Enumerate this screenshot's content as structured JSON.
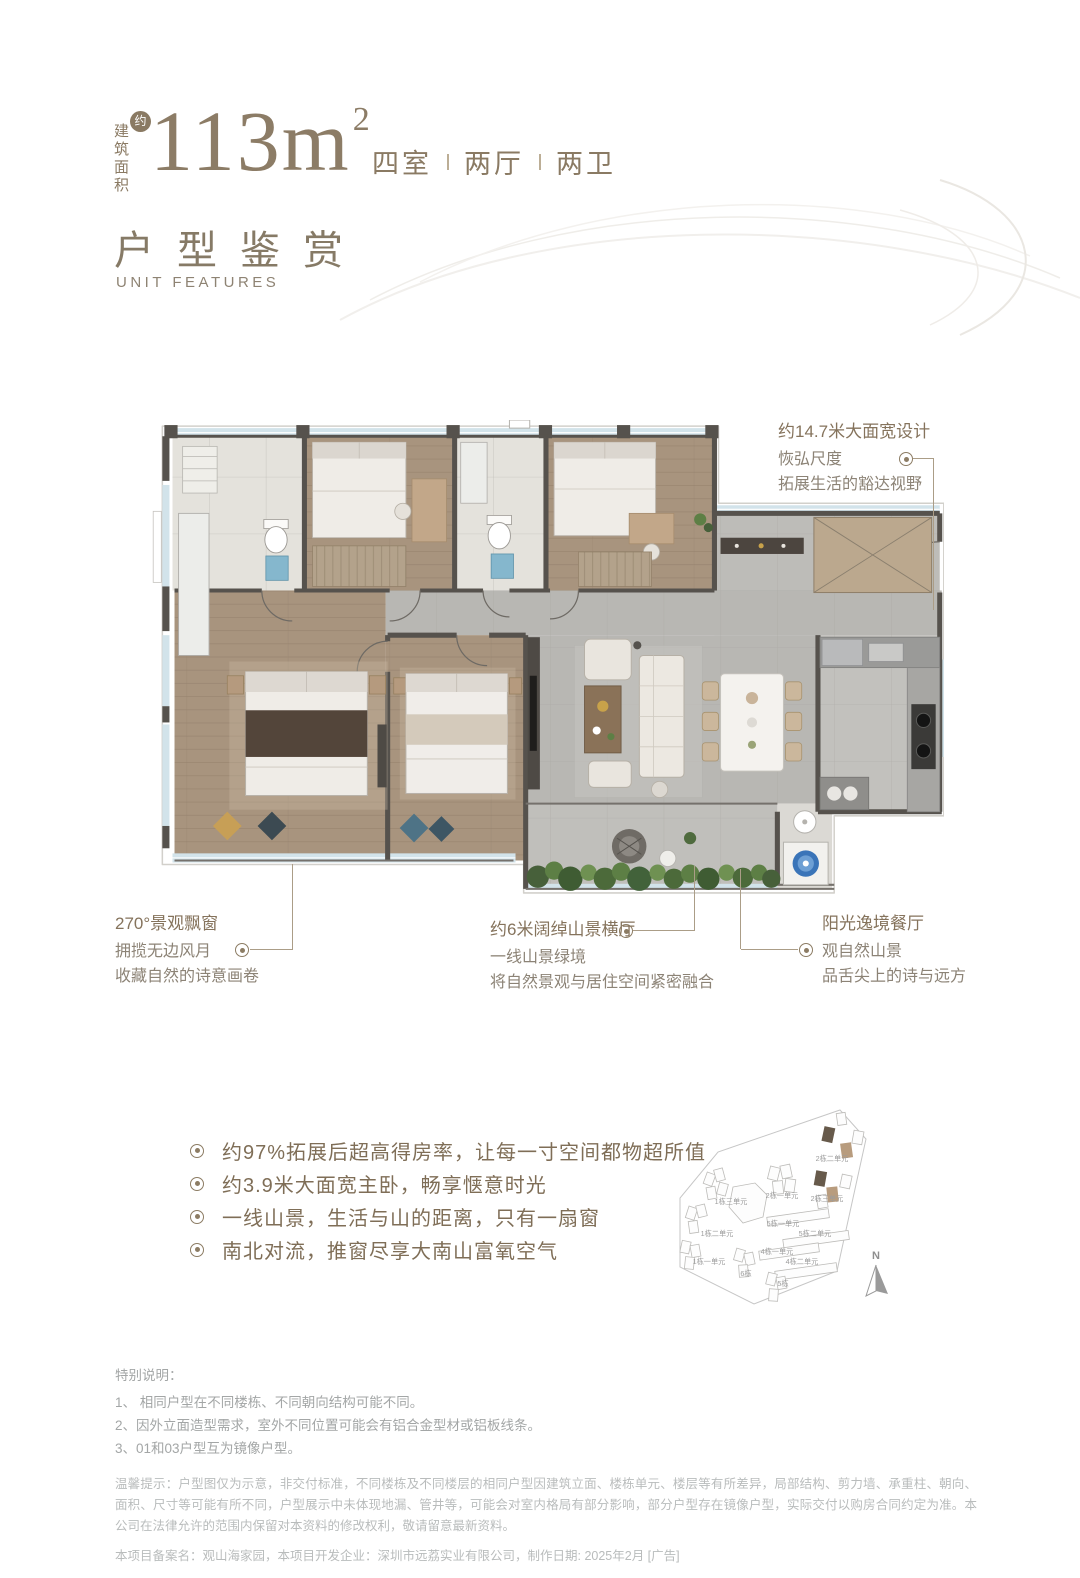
{
  "header": {
    "area_prefix": "建筑面积",
    "approx_badge": "约",
    "area_number": "113m",
    "area_superscript": "2",
    "specs": [
      "四室",
      "两厅",
      "两卫"
    ],
    "section_title": "户型鉴赏",
    "section_subtitle": "UNIT FEATURES"
  },
  "annotations": {
    "top_right": {
      "title": "约14.7米大面宽设计",
      "line1": "恢弘尺度",
      "line2": "拓展生活的豁达视野"
    },
    "bottom_left": {
      "title": "270°景观飘窗",
      "line1": "拥揽无边风月",
      "line2": "收藏自然的诗意画卷"
    },
    "bottom_middle": {
      "title": "约6米阔绰山景横厅",
      "line1": "一线山景绿境",
      "line2": "将自然景观与居住空间紧密融合"
    },
    "bottom_right": {
      "title": "阳光逸境餐厅",
      "line1": "观自然山景",
      "line2": "品舌尖上的诗与远方"
    }
  },
  "selling_points": [
    "约97%拓展后超高得房率，让每一寸空间都物超所值",
    "约3.9米大面宽主卧，畅享惬意时光",
    "一线山景，生活与山的距离，只有一扇窗",
    "南北对流，推窗尽享大南山富氧空气"
  ],
  "site_map": {
    "compass_label": "N",
    "building_labels": [
      "2栋二单元",
      "2栋一单元",
      "2栋三单元",
      "1栋三单元",
      "5栋一单元",
      "5栋二单元",
      "1栋二单元",
      "4栋一单元",
      "4栋二单元",
      "1栋一单元",
      "6栋",
      "5栋"
    ]
  },
  "footnotes": {
    "special_title": "特别说明：",
    "special_items": [
      "1、 相同户型在不同楼栋、不同朝向结构可能不同。",
      "2、因外立面造型需求，室外不同位置可能会有铝合金型材或铝板线条。",
      "3、01和03户型互为镜像户型。"
    ],
    "disclaimer": "温馨提示：户型图仅为示意，非交付标准，不同楼栋及不同楼层的相同户型因建筑立面、楼栋单元、楼层等有所差异，局部结构、剪力墙、承重柱、朝向、面积、尺寸等可能有所不同，户型展示中未体现地漏、管井等，可能会对室内格局有部分影响，部分户型存在镜像户型，实际交付以购房合同约定为准。本公司在法律允许的范围内保留对本资料的修改权利，敬请留意最新资料。",
    "record_line": "本项目备案名：观山海家园，本项目开发企业：深圳市远荔实业有限公司，制作日期: 2025年2月 [广告]"
  },
  "colors": {
    "brand_brown": "#8a7a63",
    "connector": "#ab9d87",
    "footnote_gray": "#a3a6a6",
    "disclaimer_gray": "#b9bcbc"
  }
}
